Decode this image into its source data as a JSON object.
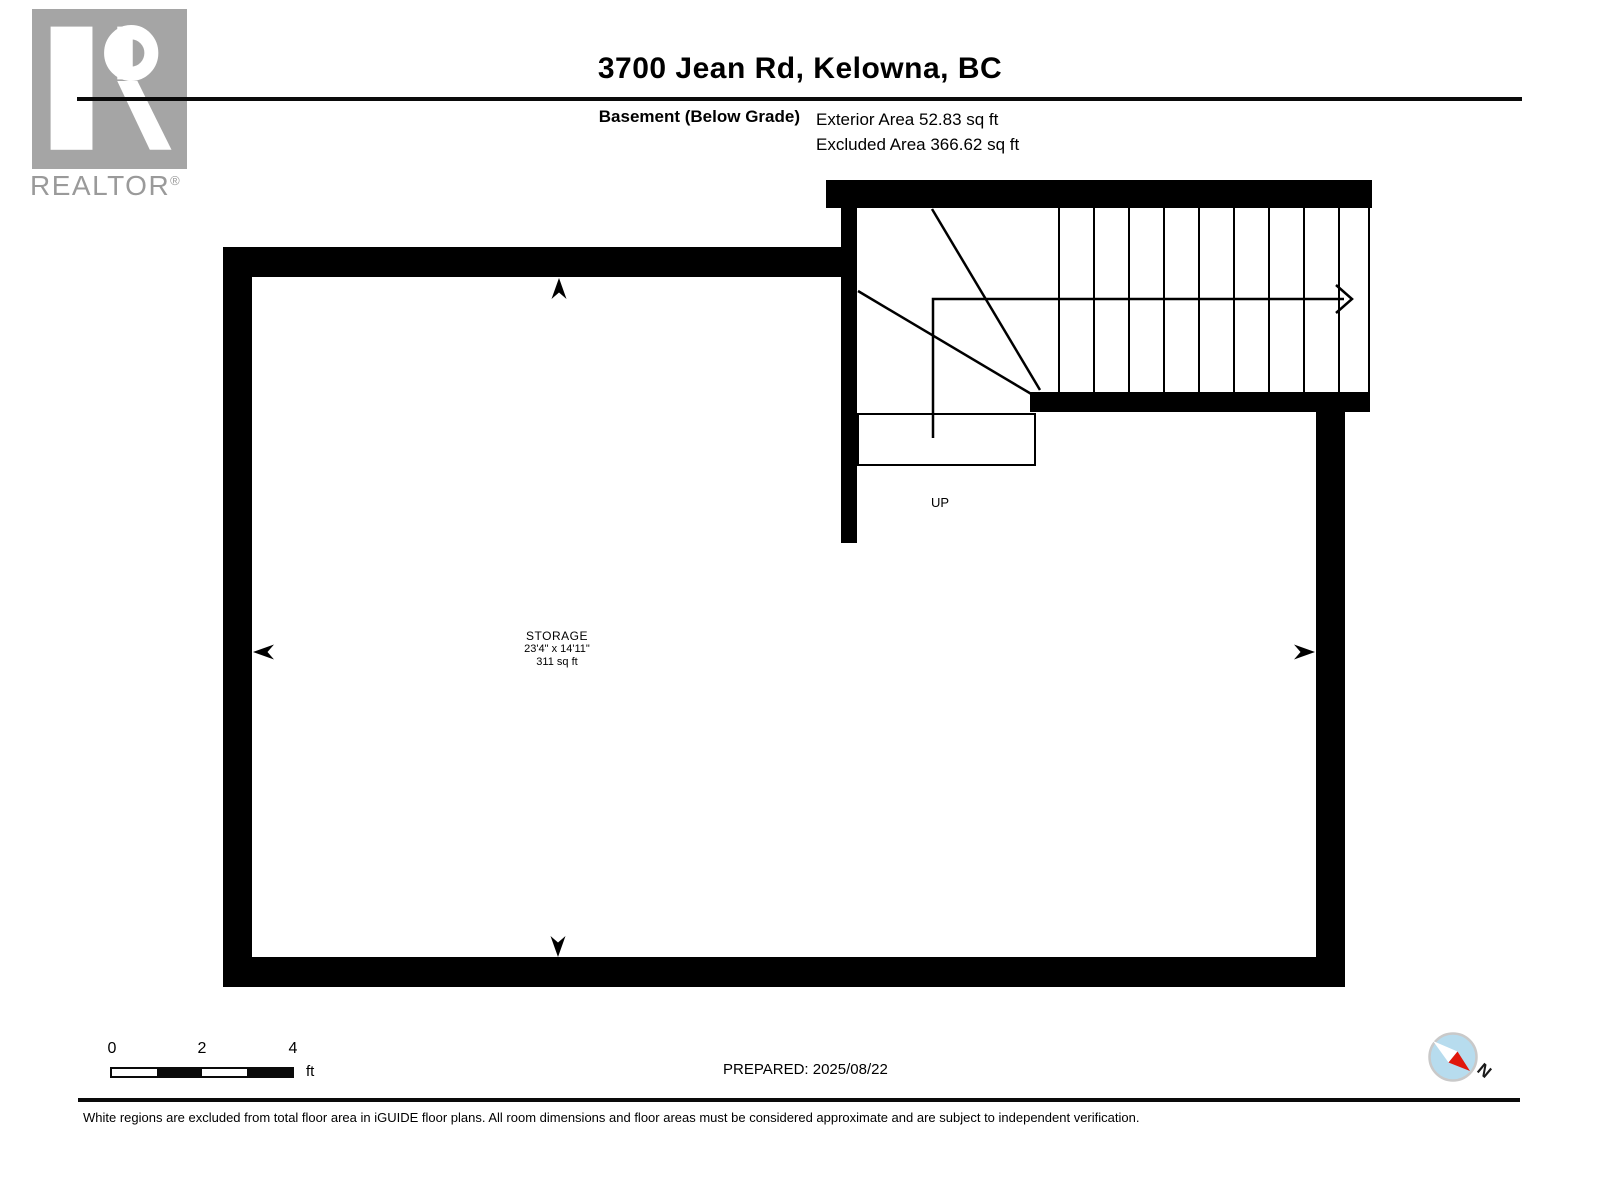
{
  "header": {
    "title": "3700 Jean Rd, Kelowna, BC",
    "floor_label": "Basement (Below Grade)",
    "exterior_area": "Exterior Area 52.83 sq ft",
    "excluded_area": "Excluded Area 366.62 sq ft"
  },
  "branding": {
    "logo_text": "REALTOR",
    "registered_mark": "®"
  },
  "floorplan": {
    "room": {
      "name": "STORAGE",
      "dimensions": "23'4\" x 14'11\"",
      "area": "311 sq ft"
    },
    "stairs": {
      "direction_label": "UP"
    }
  },
  "scale_bar": {
    "tick_labels": [
      "0",
      "2",
      "4"
    ],
    "unit": "ft"
  },
  "footer": {
    "prepared_label": "PREPARED: 2025/08/22",
    "disclaimer": "White regions are excluded from total floor area in iGUIDE floor plans. All room dimensions and floor areas must be considered approximate and are subject to independent verification.",
    "compass_north_label": "N"
  },
  "colors": {
    "wall": "#000000",
    "logo_gray": "#a5a5a5",
    "logo_text_gray": "#9a9a9a",
    "compass_blue": "#b7dcee",
    "compass_red": "#e0170b",
    "compass_ring": "#c9c9c9"
  }
}
